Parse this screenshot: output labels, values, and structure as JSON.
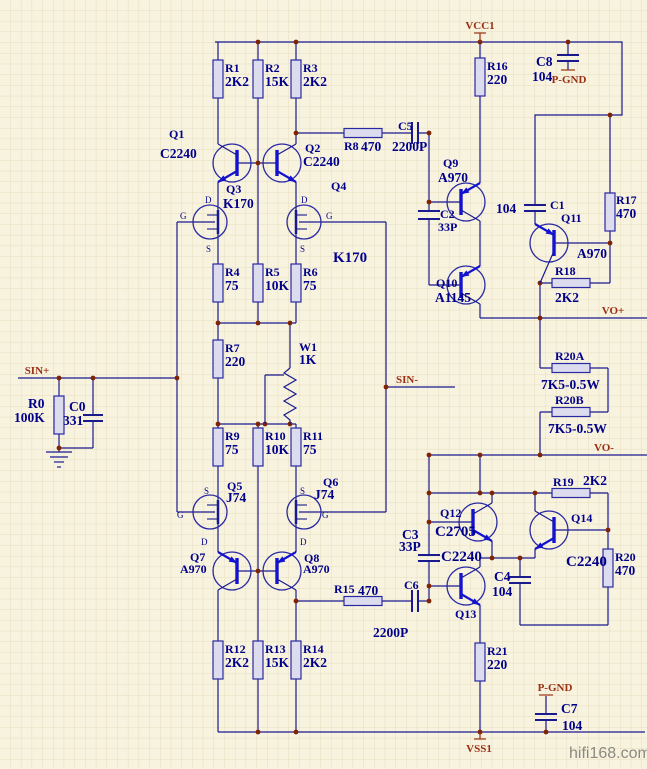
{
  "watermark": "hifi168.com",
  "colors": {
    "background": "#F8F3DF",
    "grid": "#E6DDBE",
    "wire": "#1A1A8F",
    "component_accent": "#1313CF",
    "label": "#00008B",
    "port": "#9B2F12",
    "junction": "#7E2303",
    "watermark": "#8A8A80"
  },
  "pins": {
    "drain": "D",
    "gate": "G",
    "source": "S"
  },
  "ports": {
    "vcc": "VCC1",
    "vss": "VSS1",
    "sin_plus": "SIN+",
    "sin_minus": "SIN-",
    "vo_plus": "VO+",
    "vo_minus": "VO-",
    "pgnd_top": "P-GND",
    "pgnd_bottom": "P-GND"
  },
  "components": {
    "R0": {
      "ref": "R0",
      "value": "100K"
    },
    "R1": {
      "ref": "R1",
      "value": "2K2"
    },
    "R2": {
      "ref": "R2",
      "value": "15K"
    },
    "R3": {
      "ref": "R3",
      "value": "2K2"
    },
    "R4": {
      "ref": "R4",
      "value": "75"
    },
    "R5": {
      "ref": "R5",
      "value": "10K"
    },
    "R6": {
      "ref": "R6",
      "value": "75"
    },
    "R7": {
      "ref": "R7",
      "value": "220"
    },
    "R8": {
      "ref": "R8",
      "value": "470"
    },
    "R9": {
      "ref": "R9",
      "value": "75"
    },
    "R10": {
      "ref": "R10",
      "value": "10K"
    },
    "R11": {
      "ref": "R11",
      "value": "75"
    },
    "R12": {
      "ref": "R12",
      "value": "2K2"
    },
    "R13": {
      "ref": "R13",
      "value": "15K"
    },
    "R14": {
      "ref": "R14",
      "value": "2K2"
    },
    "R15": {
      "ref": "R15",
      "value": "470"
    },
    "R16": {
      "ref": "R16",
      "value": "220"
    },
    "R17": {
      "ref": "R17",
      "value": "470"
    },
    "R18": {
      "ref": "R18",
      "value": "2K2"
    },
    "R19": {
      "ref": "R19",
      "value": "2K2"
    },
    "R20": {
      "ref": "R20",
      "value": "470"
    },
    "R20A": {
      "ref": "R20A",
      "value": "7K5-0.5W"
    },
    "R20B": {
      "ref": "R20B",
      "value": "7K5-0.5W"
    },
    "R21": {
      "ref": "R21",
      "value": "220"
    },
    "W1": {
      "ref": "W1",
      "value": "1K"
    },
    "C0": {
      "ref": "C0",
      "value": "331"
    },
    "C1": {
      "ref": "C1",
      "value": "104"
    },
    "C2": {
      "ref": "C2",
      "value": "33P"
    },
    "C3": {
      "ref": "C3",
      "value": "33P"
    },
    "C4": {
      "ref": "C4",
      "value": "104"
    },
    "C5": {
      "ref": "C5",
      "value": "2200P"
    },
    "C6": {
      "ref": "C6",
      "value": "2200P"
    },
    "C7": {
      "ref": "C7",
      "value": "104"
    },
    "C8": {
      "ref": "C8",
      "value": "104"
    },
    "Q1": {
      "ref": "Q1",
      "value": "C2240"
    },
    "Q2": {
      "ref": "Q2",
      "value": "C2240"
    },
    "Q3": {
      "ref": "Q3",
      "value": "K170"
    },
    "Q4": {
      "ref": "Q4",
      "value": "K170"
    },
    "Q5": {
      "ref": "Q5",
      "value": "J74"
    },
    "Q6": {
      "ref": "Q6",
      "value": "J74"
    },
    "Q7": {
      "ref": "Q7",
      "value": "A970"
    },
    "Q8": {
      "ref": "Q8",
      "value": "A970"
    },
    "Q9": {
      "ref": "Q9",
      "value": "A970"
    },
    "Q10": {
      "ref": "Q10",
      "value": "A1145"
    },
    "Q11": {
      "ref": "Q11",
      "value": "A970"
    },
    "Q12": {
      "ref": "Q12",
      "value": "C2705"
    },
    "Q13": {
      "ref": "Q13",
      "value": "C2240"
    },
    "Q14": {
      "ref": "Q14",
      "value": "C2240"
    }
  }
}
